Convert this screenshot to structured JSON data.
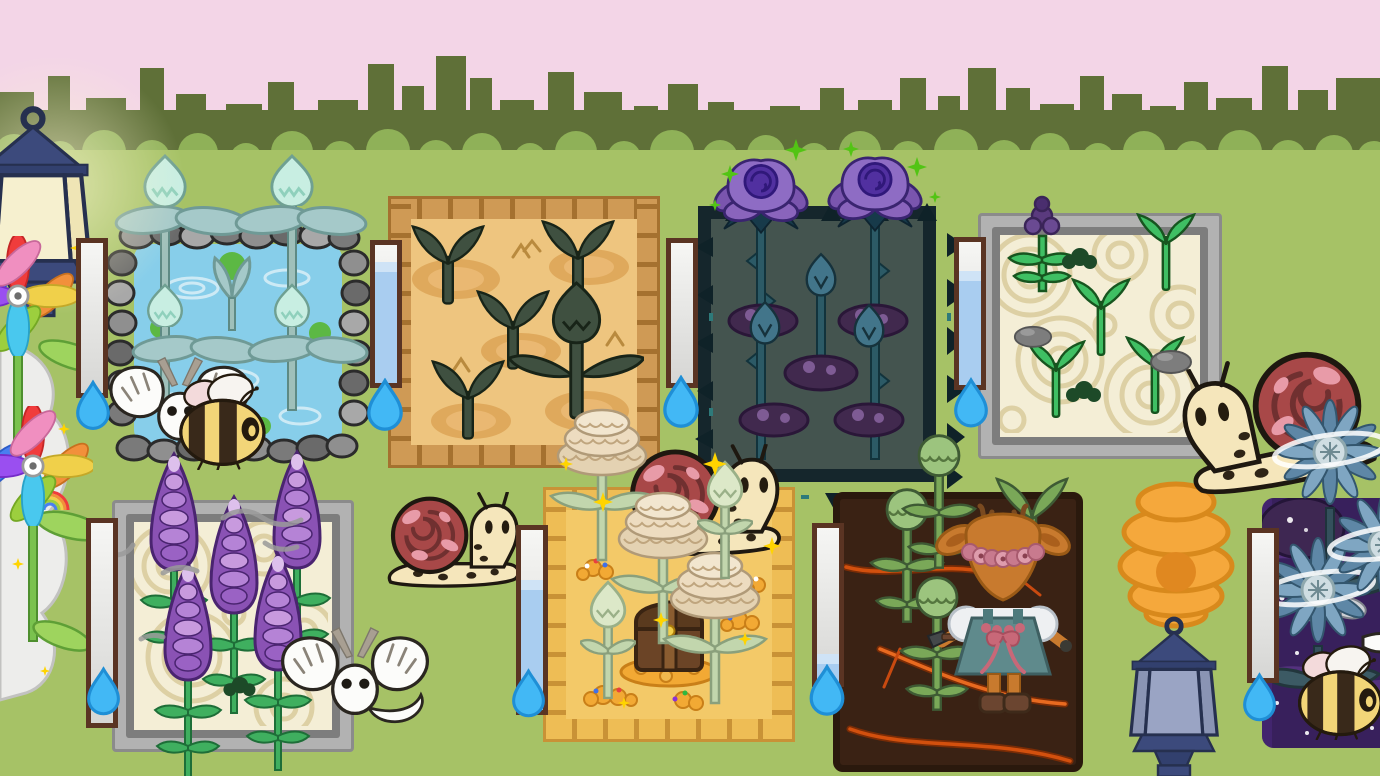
{
  "scene": {
    "name": "cozy-garden",
    "width": 1380,
    "height": 776
  },
  "colors": {
    "sky": "#f3d5e7",
    "hedge": "#5f7038",
    "hedge-light": "#8fb158",
    "grass": "#a6c266",
    "gauge-border": "#5a3423",
    "gauge-water": "#a9cdf0",
    "droplet": "#42b8f5",
    "droplet-edge": "#1f8fd6",
    "water": "#87ceea",
    "brick": "#cf9a55",
    "brick-gap": "#a5712f",
    "sand": "#eec57f",
    "gold-brick": "#eebd55",
    "gold-gap": "#c99236",
    "gold-sand": "#f3c968",
    "thorn-frame": "#15262c",
    "thorn-soil": "#44544f",
    "zen-sand": "#f4eed6",
    "soil": "#3a2214",
    "galaxy": "#38205c"
  },
  "plots": [
    {
      "name": "pond-plot",
      "terrain": "pond",
      "border": "stones",
      "plant": "mint-water-bud",
      "plant_count": 5,
      "growth_stage": "budding",
      "water_gauge": {
        "fill_percent": 0
      }
    },
    {
      "name": "sand-plot",
      "terrain": "sand",
      "border": "clay-bricks",
      "plant": "dark-sprout",
      "plant_count": 5,
      "growth_stage": "sprout",
      "water_gauge": {
        "fill_percent": 88
      }
    },
    {
      "name": "thorn-plot",
      "terrain": "shadow-soil",
      "border": "thorns",
      "plant": "purple-rose",
      "plant_count": 5,
      "growth_stage": "blooming",
      "water_gauge": {
        "fill_percent": 0
      }
    },
    {
      "name": "zen-plot",
      "terrain": "raked-sand",
      "border": "stone-frame",
      "plant": "green-sprout",
      "plant_count": 4,
      "extra_plant": "lavender-bloom",
      "growth_stage": "sprout",
      "water_gauge": {
        "fill_percent": 80
      }
    },
    {
      "name": "lavender-plot",
      "terrain": "raked-sand",
      "border": "stone-frame",
      "plant": "lavender",
      "plant_count": 5,
      "growth_stage": "blooming",
      "water_gauge": {
        "fill_percent": 0
      }
    },
    {
      "name": "treasure-plot",
      "terrain": "golden-sand",
      "border": "gold-bricks",
      "plant": "cream-marigold",
      "plant_count": 5,
      "growth_stage": "blooming",
      "decor": "treasure-chest-with-coins",
      "water_gauge": {
        "fill_percent": 72
      }
    },
    {
      "name": "soil-plot",
      "terrain": "dark-soil-with-embers",
      "border": "none",
      "plant": "snap-bud",
      "plant_count": 4,
      "growth_stage": "budding",
      "water_gauge": {
        "fill_percent": 18
      }
    },
    {
      "name": "galaxy-plot",
      "terrain": "galaxy",
      "border": "none",
      "plant": "blue-aster",
      "plant_count": 3,
      "growth_stage": "blooming",
      "water_gauge": {
        "fill_percent": 0
      }
    }
  ],
  "creatures": [
    {
      "name": "bumblebee",
      "location": "pond-plot"
    },
    {
      "name": "white-moth",
      "location": "pond-plot"
    },
    {
      "name": "snail",
      "location": "center-meadow"
    },
    {
      "name": "snail",
      "location": "treasure-plot"
    },
    {
      "name": "snail",
      "location": "right-meadow"
    },
    {
      "name": "white-moth",
      "location": "lavender-plot"
    },
    {
      "name": "deer-gardener",
      "location": "soil-plot"
    },
    {
      "name": "gray-moth",
      "location": "galaxy-plot"
    },
    {
      "name": "bumblebee",
      "location": "galaxy-plot"
    }
  ],
  "decor": [
    {
      "name": "street-lantern",
      "state": "lit"
    },
    {
      "name": "rainbow-pinwheel-flowers"
    },
    {
      "name": "beehive"
    },
    {
      "name": "street-lantern",
      "state": "unlit"
    }
  ],
  "icons": {
    "watering": "water-droplet-icon"
  }
}
